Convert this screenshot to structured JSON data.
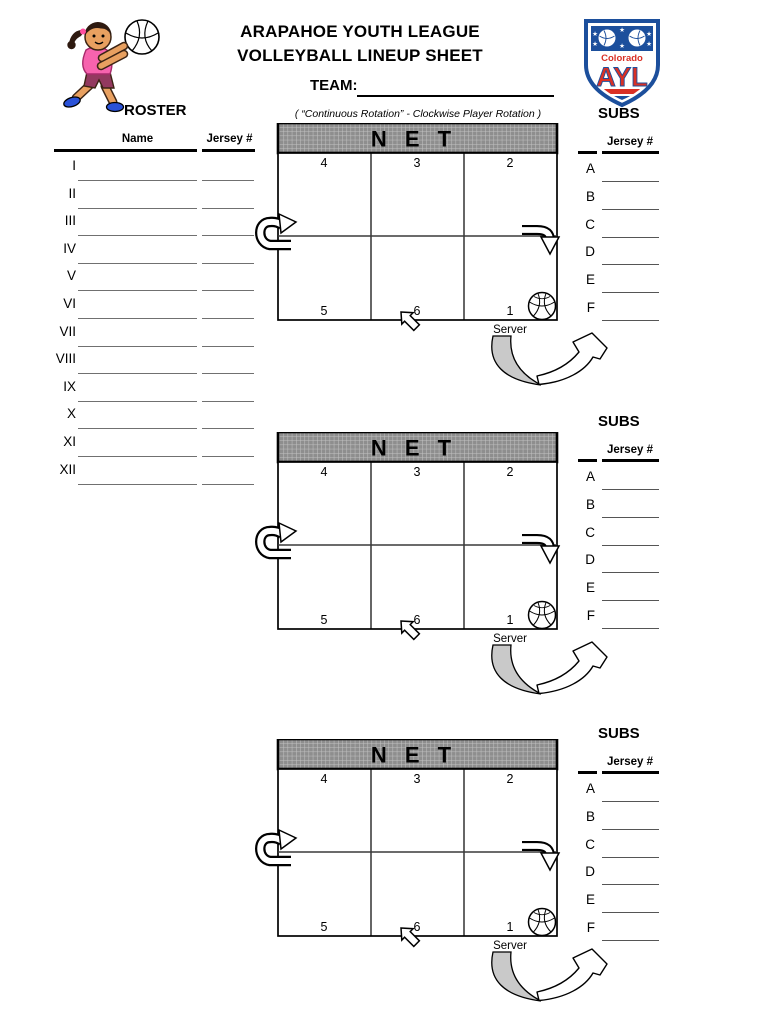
{
  "header": {
    "title_line1": "ARAPAHOE YOUTH LEAGUE",
    "title_line2": "VOLLEYBALL LINEUP SHEET",
    "team_label": "TEAM:",
    "roster_label": "ROSTER",
    "rotation_note": "( “Continuous Rotation” - Clockwise Player Rotation )"
  },
  "logo": {
    "region": "Colorado",
    "abbr": "AYL"
  },
  "roster": {
    "name_header": "Name",
    "jersey_header": "Jersey #",
    "rows": [
      "I",
      "II",
      "III",
      "IV",
      "V",
      "VI",
      "VII",
      "VIII",
      "IX",
      "X",
      "XI",
      "XII"
    ]
  },
  "subs": {
    "label": "SUBS",
    "jersey_header": "Jersey #",
    "rows": [
      "A",
      "B",
      "C",
      "D",
      "E",
      "F"
    ]
  },
  "court": {
    "net_label": "N E T",
    "front_row": [
      "4",
      "3",
      "2"
    ],
    "back_row": [
      "5",
      "6",
      "1"
    ],
    "server_label": "Server"
  },
  "icons": {
    "volleyball": "volleyball-icon",
    "rotation_left": "rotate-up-arrow-icon",
    "rotation_right": "rotate-down-arrow-icon",
    "server_path": "serve-swoosh-arrow-icon"
  },
  "colors": {
    "logo_blue": "#1c4f9c",
    "logo_red": "#d93025",
    "shirt_pink": "#f763ae",
    "net_gray": "#8e8e8e",
    "line_gray": "#707070"
  }
}
